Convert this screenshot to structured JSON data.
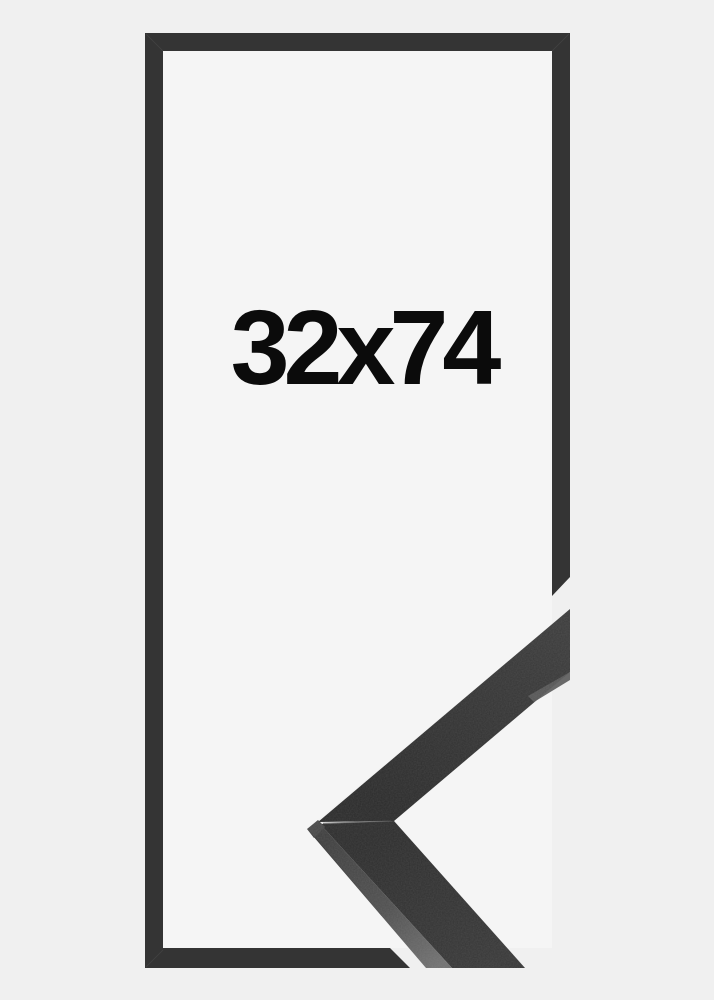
{
  "frame_preview": {
    "size_label": "32x74"
  },
  "colors": {
    "background": "#f0f0f0",
    "inner_area": "#f5f5f5",
    "frame": "#343434",
    "frame_miter_highlight": "#4a4a4a",
    "sample_face_light": "#3b3b3b",
    "sample_face_dark": "#2a2a2a",
    "sample_lower_face_start": "#2c2c2c",
    "sample_lower_face_end": "#373737",
    "sample_side_top": "#3e3e3e",
    "sample_side_bottom": "#707070",
    "sample_end_face": "#484848",
    "sample_rabbet_lip": "#5a5a5a",
    "sample_miter_seam": "#464646",
    "label_text": "#0b0b0b"
  }
}
